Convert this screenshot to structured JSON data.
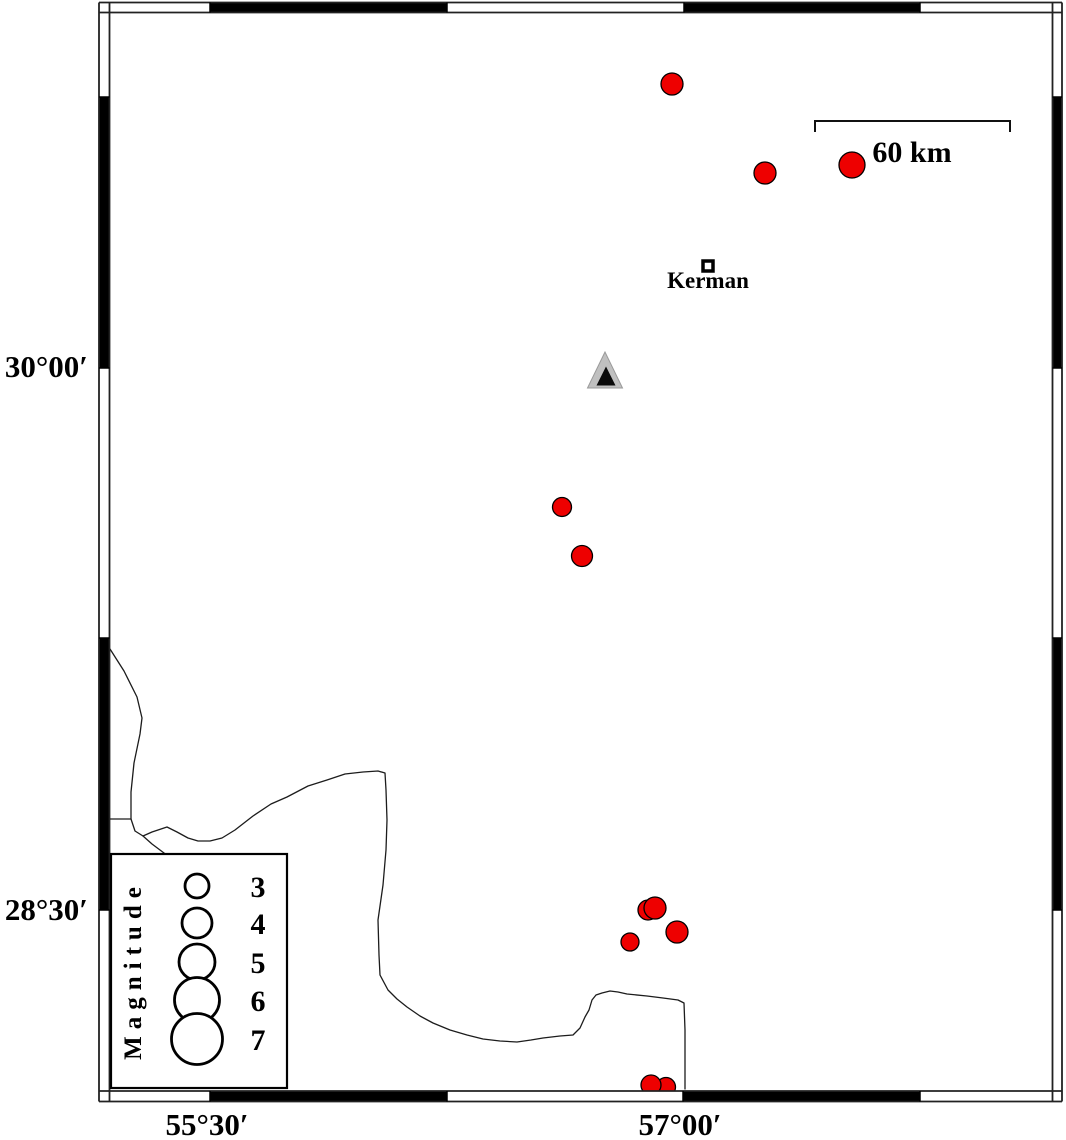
{
  "map": {
    "kind": "seismicity-map",
    "axis_labels": {
      "left": [
        {
          "text": "30°00′",
          "x": 88,
          "y": 377
        },
        {
          "text": "28°30′",
          "x": 88,
          "y": 920
        }
      ],
      "bottom": [
        {
          "text": "55°30′",
          "x": 207,
          "y": 1135
        },
        {
          "text": "57°00′",
          "x": 680,
          "y": 1135
        }
      ]
    },
    "frame": {
      "outer": {
        "x1": 99,
        "y1": 2.5,
        "x2": 1062,
        "y2": 1101.5
      },
      "inner": {
        "x1": 109.5,
        "y1": 12.5,
        "x2": 1052.5,
        "y2": 1091
      },
      "black_segments": {
        "top": [
          [
            210,
            447
          ],
          [
            684,
            920
          ]
        ],
        "bottom": [
          [
            210,
            447
          ],
          [
            683,
            920
          ]
        ],
        "left": [
          [
            97,
            368
          ],
          [
            638,
            910
          ]
        ],
        "right": [
          [
            97,
            368
          ],
          [
            638,
            910
          ]
        ]
      },
      "divisions": {
        "top": [
          210,
          447,
          684,
          920
        ],
        "bottom": [
          210,
          447,
          683,
          920
        ],
        "left": [
          97,
          368,
          638,
          910
        ],
        "right": [
          97,
          368,
          638,
          910
        ]
      }
    },
    "scale_bar": {
      "label": "60 km",
      "x1": 815,
      "x2": 1010,
      "y": 121,
      "tick_drop": 11,
      "label_x": 912,
      "label_y": 162
    },
    "city": {
      "name": "Kerman",
      "marker": {
        "x": 703,
        "y": 261,
        "size": 10
      },
      "label_x": 708,
      "label_y": 288
    },
    "station": {
      "outer_points": "605,352 587.5,388 622.5,388",
      "inner_points": "606,366.5 596.5,385.5 615.5,385.5",
      "outer_color": "#c0c0c0",
      "outer_edge": "#9a9a9a",
      "inner_color": "#0a0a0a"
    },
    "earthquakes": {
      "color": "#ee0000",
      "outline": "#000000",
      "points": [
        {
          "cx": 672,
          "cy": 84,
          "r": 11
        },
        {
          "cx": 765,
          "cy": 173,
          "r": 11
        },
        {
          "cx": 852,
          "cy": 165,
          "r": 13
        },
        {
          "cx": 562,
          "cy": 507,
          "r": 9.5
        },
        {
          "cx": 582,
          "cy": 556,
          "r": 10.5
        },
        {
          "cx": 648,
          "cy": 910,
          "r": 10
        },
        {
          "cx": 655,
          "cy": 908,
          "r": 11
        },
        {
          "cx": 677,
          "cy": 932,
          "r": 11
        },
        {
          "cx": 630,
          "cy": 942,
          "r": 9
        },
        {
          "cx": 666,
          "cy": 1087,
          "r": 9.5
        },
        {
          "cx": 651,
          "cy": 1085,
          "r": 10
        }
      ]
    },
    "coastline": {
      "color": "#1c1c1c",
      "paths": [
        "M110,649 L124,671 L137,697 L142,718 L140,734 L134,763 L131,792 L131,819 L135,831 L143,836 L152,832 L167,827 L177,832 L188,838 L198,841 L210,841 L222,838 L235,830 L253,816 L271,804 L287,797 L308,786 L327,780 L345,774 L363,772 L378,771 L385,773 L386,790 L387,820 L386,850 L383,885 L378,920 L379,955 L380,975 L388,990 L397,999 L407,1007 L420,1016 L433,1023 L450,1030 L467,1035 L483,1039 L500,1041 L517,1042 L531,1040 L543,1038 L560,1036 L573,1035 L580,1028 L585,1017 L589,1010 L592,1000 L596,995 L602,993 L610,991 L618,992 L627,994 L647,996 L663,998 L678,1000 L684,1003 L685,1030 L685,1089",
        "M110,819 L131,819",
        "M143,836 L152,844 L160,850 L168,856"
      ]
    }
  },
  "legend": {
    "title": "Magnitude",
    "box": {
      "x": 111,
      "y": 854,
      "w": 176,
      "h": 234
    },
    "title_x": 141,
    "title_y": 970,
    "circle_x": 197,
    "label_x": 258,
    "entries": [
      {
        "label": "3",
        "cy": 886,
        "r": 12
      },
      {
        "label": "4",
        "cy": 923,
        "r": 15
      },
      {
        "label": "5",
        "cy": 962,
        "r": 18
      },
      {
        "label": "6",
        "cy": 1000,
        "r": 22.5
      },
      {
        "label": "7",
        "cy": 1039,
        "r": 25.5
      }
    ]
  }
}
